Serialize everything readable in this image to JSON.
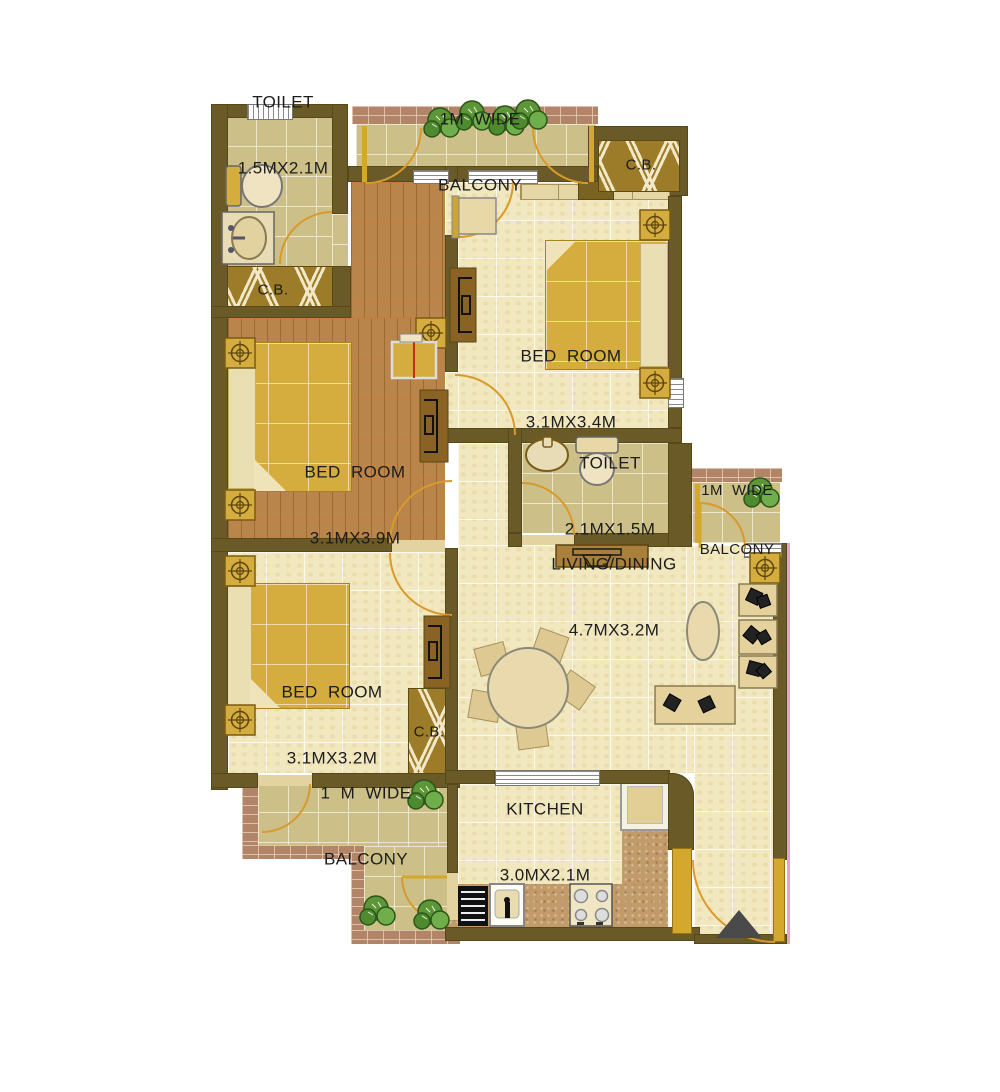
{
  "labels": {
    "toilet_top": {
      "line1": "TOILET",
      "line2": "1.5MX2.1M"
    },
    "balcony_top": {
      "line1": "1M  WIDE",
      "line2": "BALCONY"
    },
    "cb_top_left": {
      "text": "C.B."
    },
    "cb_entrance": {
      "text": "C.B."
    },
    "cb_bedroom3": {
      "text": "C.B."
    },
    "bedroom_top_right": {
      "line1": "BED  ROOM",
      "line2": "3.1MX3.4M"
    },
    "bedroom_mid_left": {
      "line1": "BED  ROOM",
      "line2": "3.1MX3.9M"
    },
    "toilet_middle": {
      "line1": "TOILET",
      "line2": "2.1MX1.5M"
    },
    "balcony_right": {
      "line1": "1M  WIDE",
      "line2": "BALCONY"
    },
    "living_dining": {
      "line1": "LIVING/DINING",
      "line2": "4.7MX3.2M"
    },
    "bedroom_bottom": {
      "line1": "BED  ROOM",
      "line2": "3.1MX3.2M"
    },
    "balcony_bottom": {
      "line1": "1  M  WIDE",
      "line2": "BALCONY"
    },
    "kitchen": {
      "line1": "KITCHEN",
      "line2": "3.0MX2.1M"
    }
  },
  "colors": {
    "wall": "#6a5a28",
    "floor_tile": "#f2e8c0",
    "balcony_tile": "#ccbf88",
    "wood_floor": "#b9854a",
    "brick_trim": "#b28569",
    "furniture_gold": "#d4ad3e",
    "door_arc": "#d89a2b",
    "plant_green": "#5d9638",
    "text": "#1c1c1c",
    "boundary_pink": "#f0a0c0"
  }
}
